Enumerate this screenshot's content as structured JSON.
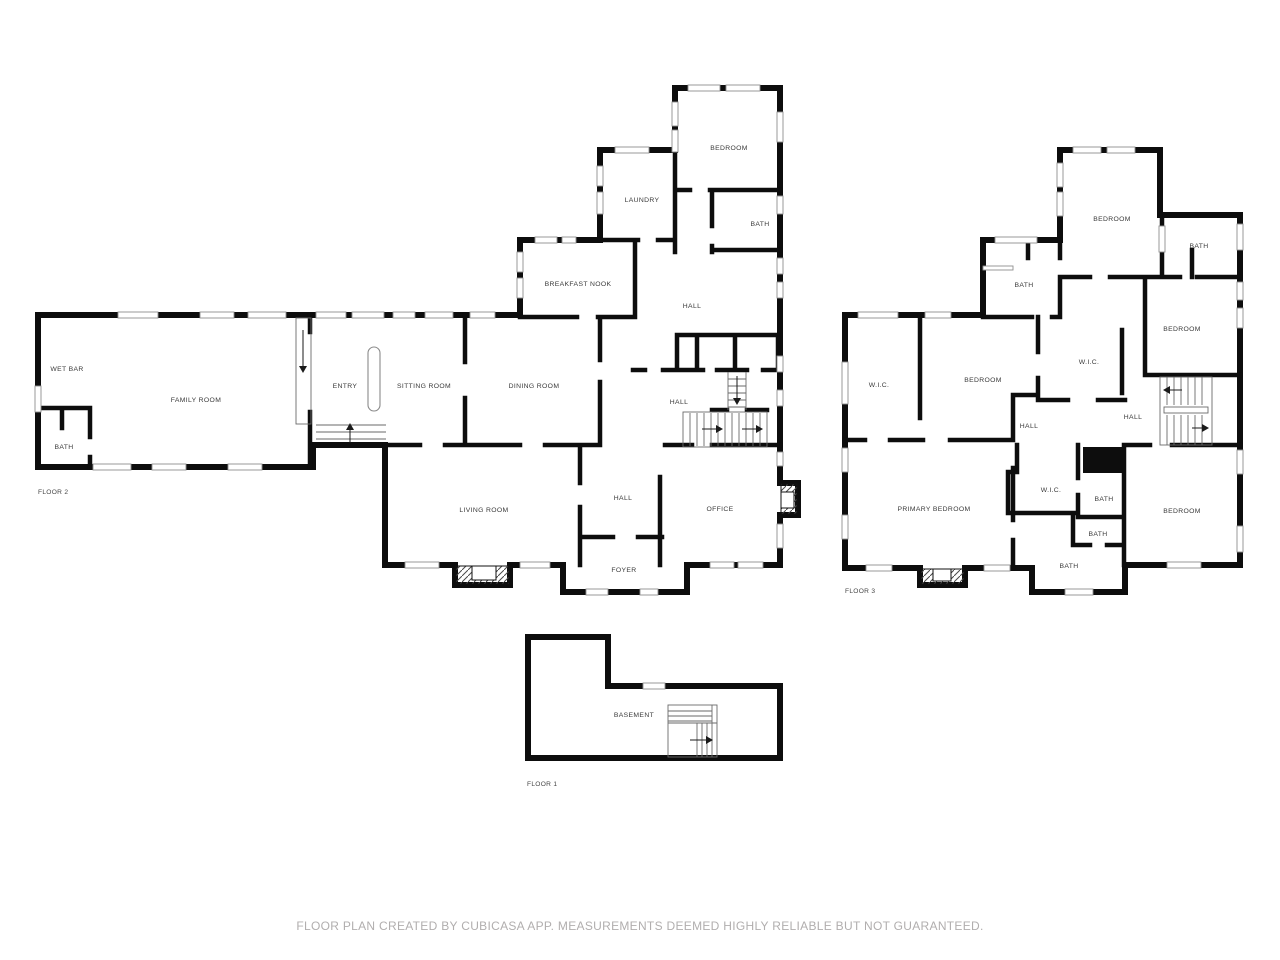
{
  "footer": {
    "disclaimer": "FLOOR PLAN CREATED BY CUBICASA APP. MEASUREMENTS DEEMED HIGHLY RELIABLE BUT NOT GUARANTEED."
  },
  "floor2": {
    "name": "FLOOR 2",
    "rooms": {
      "wet_bar": "WET BAR",
      "family_room": "FAMILY ROOM",
      "bath": "BATH",
      "entry": "ENTRY",
      "sitting_room": "SITTING ROOM",
      "dining_room": "DINING ROOM",
      "breakfast_nook": "BREAKFAST NOOK",
      "laundry": "LAUNDRY",
      "bedroom": "BEDROOM",
      "bath_upper": "BATH",
      "hall_upper": "HALL",
      "hall_mid": "HALL",
      "hall_lower": "HALL",
      "living_room": "LIVING ROOM",
      "office": "OFFICE",
      "foyer": "FOYER"
    }
  },
  "floor3": {
    "name": "FLOOR 3",
    "rooms": {
      "bedroom_top": "BEDROOM",
      "bath_top_right": "BATH",
      "bath_top_left": "BATH",
      "bedroom_right": "BEDROOM",
      "wic_center": "W.I.C.",
      "wic_left": "W.I.C.",
      "bedroom_center": "BEDROOM",
      "hall_center": "HALL",
      "hall_stairs": "HALL",
      "primary_bedroom": "PRIMARY BEDROOM",
      "wic_lower": "W.I.C.",
      "bath_mid": "BATH",
      "bath_small": "BATH",
      "bath_bottom": "BATH",
      "bedroom_bottom": "BEDROOM"
    }
  },
  "floor1": {
    "name": "FLOOR 1",
    "rooms": {
      "basement": "BASEMENT"
    }
  },
  "colors": {
    "wall": "#0d0d0d",
    "background": "#ffffff",
    "room_label": "#3a3a3a",
    "floor_label": "#454545",
    "footer_text": "#b1aeae",
    "window_stroke": "#8f8f8f",
    "stair_stroke": "#6a6a6a"
  }
}
